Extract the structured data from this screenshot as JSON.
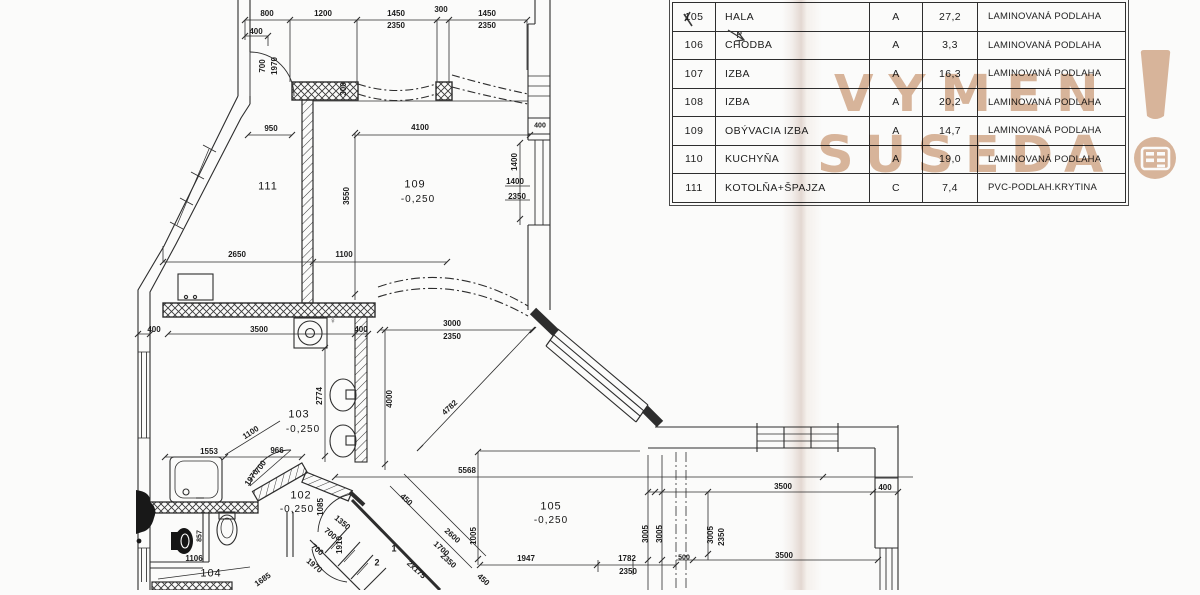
{
  "legend_table": {
    "rows": [
      {
        "no": "105",
        "name": "HALA",
        "cat": "A",
        "area": "27,2",
        "floor": "LAMINOVANÁ PODLAHA"
      },
      {
        "no": "106",
        "name": "CHODBA",
        "cat": "A",
        "area": "3,3",
        "floor": "LAMINOVANÁ PODLAHA"
      },
      {
        "no": "107",
        "name": "IZBA",
        "cat": "A",
        "area": "16,3",
        "floor": "LAMINOVANÁ PODLAHA"
      },
      {
        "no": "108",
        "name": "IZBA",
        "cat": "A",
        "area": "20,2",
        "floor": "LAMINOVANÁ PODLAHA"
      },
      {
        "no": "109",
        "name": "OBÝVACIA IZBA",
        "cat": "A",
        "area": "14,7",
        "floor": "LAMINOVANÁ PODLAHA"
      },
      {
        "no": "110",
        "name": "KUCHYŇA",
        "cat": "A",
        "area": "19,0",
        "floor": "LAMINOVANÁ PODLAHA"
      },
      {
        "no": "111",
        "name": "KOTOLŇA+ŠPAJZA",
        "cat": "C",
        "area": "7,4",
        "floor": "PVC-PODLAH.KRYTINA"
      }
    ]
  },
  "watermark": {
    "line1": "VYMEN",
    "line2": "SUSEDA",
    "color": "#d9b398"
  },
  "labels": [
    {
      "t": "800",
      "x": 267,
      "y": 14
    },
    {
      "t": "1200",
      "x": 323,
      "y": 14
    },
    {
      "t": "1450",
      "x": 396,
      "y": 14
    },
    {
      "t": "2350",
      "x": 396,
      "y": 26
    },
    {
      "t": "300",
      "x": 441,
      "y": 10
    },
    {
      "t": "1450",
      "x": 487,
      "y": 14
    },
    {
      "t": "2350",
      "x": 487,
      "y": 26
    },
    {
      "t": "400",
      "x": 256,
      "y": 32
    },
    {
      "t": "700",
      "x": 263,
      "y": 66,
      "r": -90
    },
    {
      "t": "1970",
      "x": 275,
      "y": 66,
      "r": -90
    },
    {
      "t": "300",
      "x": 344,
      "y": 89,
      "r": -90
    },
    {
      "t": "950",
      "x": 271,
      "y": 129
    },
    {
      "t": "4100",
      "x": 420,
      "y": 128
    },
    {
      "t": "400",
      "x": 540,
      "y": 126,
      "s": 7
    },
    {
      "t": "3550",
      "x": 347,
      "y": 196,
      "r": -90
    },
    {
      "t": "1400",
      "x": 515,
      "y": 162,
      "r": -90
    },
    {
      "t": "1400",
      "x": 515,
      "y": 182
    },
    {
      "t": "2350",
      "x": 517,
      "y": 197
    },
    {
      "t": "111",
      "x": 268,
      "y": 187,
      "s": 11,
      "c": "room"
    },
    {
      "t": "109",
      "x": 415,
      "y": 185,
      "s": 11,
      "c": "room"
    },
    {
      "t": "-0,250",
      "x": 418,
      "y": 200,
      "s": 10,
      "c": "room"
    },
    {
      "t": "2650",
      "x": 237,
      "y": 255
    },
    {
      "t": "1100",
      "x": 344,
      "y": 255
    },
    {
      "t": "400",
      "x": 154,
      "y": 330
    },
    {
      "t": "3500",
      "x": 259,
      "y": 330
    },
    {
      "t": "400",
      "x": 361,
      "y": 330
    },
    {
      "t": "♀",
      "x": 333,
      "y": 321,
      "s": 9
    },
    {
      "t": "2774",
      "x": 320,
      "y": 396,
      "r": -90
    },
    {
      "t": "103",
      "x": 299,
      "y": 415,
      "s": 11,
      "c": "room"
    },
    {
      "t": "-0,250",
      "x": 303,
      "y": 430,
      "s": 10,
      "c": "room"
    },
    {
      "t": "4000",
      "x": 390,
      "y": 399,
      "r": -90
    },
    {
      "t": "3000",
      "x": 452,
      "y": 324
    },
    {
      "t": "2350",
      "x": 452,
      "y": 337
    },
    {
      "t": "4782",
      "x": 450,
      "y": 408,
      "r": -43
    },
    {
      "t": "1100",
      "x": 251,
      "y": 433,
      "r": -33
    },
    {
      "t": "1553",
      "x": 209,
      "y": 452
    },
    {
      "t": "966",
      "x": 277,
      "y": 451
    },
    {
      "t": "700",
      "x": 261,
      "y": 467,
      "r": -55
    },
    {
      "t": "1970",
      "x": 252,
      "y": 478,
      "r": -55
    },
    {
      "t": "102",
      "x": 301,
      "y": 496,
      "s": 11,
      "c": "room"
    },
    {
      "t": "-0,250",
      "x": 297,
      "y": 510,
      "s": 10,
      "c": "room"
    },
    {
      "t": "1085",
      "x": 321,
      "y": 507,
      "r": -90
    },
    {
      "t": "1350",
      "x": 342,
      "y": 523,
      "r": 40
    },
    {
      "t": "700",
      "x": 330,
      "y": 534,
      "r": 40
    },
    {
      "t": "1910",
      "x": 340,
      "y": 545,
      "r": -90
    },
    {
      "t": "700",
      "x": 317,
      "y": 550,
      "r": 40
    },
    {
      "t": "1970",
      "x": 314,
      "y": 566,
      "r": 40
    },
    {
      "t": "104",
      "x": 211,
      "y": 574,
      "s": 11,
      "c": "room"
    },
    {
      "t": "1106",
      "x": 194,
      "y": 559
    },
    {
      "t": "857",
      "x": 200,
      "y": 536,
      "r": -90,
      "s": 7
    },
    {
      "t": "1685",
      "x": 263,
      "y": 580,
      "r": -35
    },
    {
      "t": "1",
      "x": 394,
      "y": 549,
      "s": 9
    },
    {
      "t": "2",
      "x": 377,
      "y": 563,
      "s": 9
    },
    {
      "t": "2x175",
      "x": 416,
      "y": 570,
      "r": 42
    },
    {
      "t": "450",
      "x": 406,
      "y": 500,
      "r": 42
    },
    {
      "t": "450",
      "x": 483,
      "y": 580,
      "r": 42
    },
    {
      "t": "2600",
      "x": 452,
      "y": 536,
      "r": 42
    },
    {
      "t": "1700",
      "x": 441,
      "y": 549,
      "r": 42
    },
    {
      "t": "2350",
      "x": 448,
      "y": 561,
      "r": 42
    },
    {
      "t": "1005",
      "x": 474,
      "y": 536,
      "r": -90
    },
    {
      "t": "5568",
      "x": 467,
      "y": 471
    },
    {
      "t": "105",
      "x": 551,
      "y": 507,
      "s": 11,
      "c": "room"
    },
    {
      "t": "-0,250",
      "x": 551,
      "y": 521,
      "s": 10,
      "c": "room"
    },
    {
      "t": "1947",
      "x": 526,
      "y": 559
    },
    {
      "t": "1782",
      "x": 627,
      "y": 559
    },
    {
      "t": "2350",
      "x": 628,
      "y": 572
    },
    {
      "t": "3005",
      "x": 646,
      "y": 534,
      "r": -90
    },
    {
      "t": "3005",
      "x": 660,
      "y": 534,
      "r": -90
    },
    {
      "t": "3005",
      "x": 711,
      "y": 535,
      "r": -90
    },
    {
      "t": "2350",
      "x": 722,
      "y": 537,
      "r": -90
    },
    {
      "t": "500",
      "x": 684,
      "y": 558,
      "s": 7
    },
    {
      "t": "3500",
      "x": 783,
      "y": 487
    },
    {
      "t": "400",
      "x": 885,
      "y": 488
    },
    {
      "t": "3500",
      "x": 784,
      "y": 556
    },
    {
      "t": "P",
      "x": 739,
      "y": 36,
      "s": 10,
      "c": "pencil"
    }
  ]
}
